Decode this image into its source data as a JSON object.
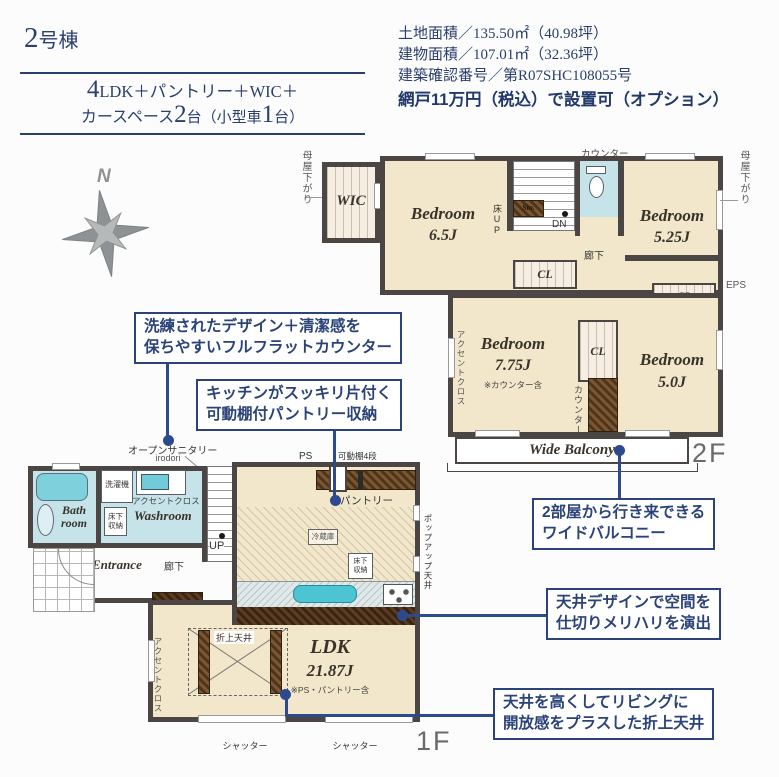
{
  "header": {
    "building_number": "2",
    "building_suffix": "号棟",
    "spec": {
      "n1": "4",
      "t1": "LDK＋パントリー＋WIC＋",
      "t2": "カースペース",
      "n2": "2",
      "t3": "台（小型車",
      "n3": "1",
      "t4": "台）"
    },
    "info": {
      "land": "土地面積／135.50㎡（40.98坪）",
      "building": "建物面積／107.01㎡（32.36坪）",
      "permit": "建築確認番号／第R07SHC108055号",
      "screen_option": "網戸11万円（税込）で設置可（オプション）"
    }
  },
  "compass": {
    "north": "N"
  },
  "floor2": {
    "floor_label": "2F",
    "moya_sagari_left": "母屋下がり",
    "moya_sagari_right": "母屋下がり",
    "wic": "WIC",
    "bedroom_65": {
      "name": "Bedroom",
      "size": "6.5J"
    },
    "yuka_up": "床UP",
    "sto": "Sto.",
    "dn": "DN",
    "counter_top": "カウンター",
    "bedroom_525": {
      "name": "Bedroom",
      "size": "5.25J"
    },
    "hallway": "廊下",
    "cl": "CL",
    "eps": "EPS",
    "accent_cloth": "アクセントクロス",
    "bedroom_775": {
      "name": "Bedroom",
      "size": "7.75J",
      "note": "※カウンター含"
    },
    "bedroom_50": {
      "name": "Bedroom",
      "size": "5.0J"
    },
    "counter_side": "カウンター",
    "balcony": "Wide Balcony"
  },
  "floor1": {
    "floor_label": "1F",
    "open_sanitary": "オープンサニタリー",
    "open_sanitary_sub": "irodori",
    "bath_a": "Bath",
    "bath_b": "room",
    "washer": "洗濯機",
    "accent_cloth_top": "アクセントクロス",
    "underfloor_a": "床下",
    "underfloor_b": "収納",
    "washroom": "Washroom",
    "sto": "Sto.",
    "entrance": "Entrance",
    "hallway": "廊下",
    "up": "UP",
    "ps": "PS",
    "movable_shelf": "可動棚4段",
    "pantry": "パントリー",
    "fridge": "冷蔵庫",
    "popup_ceiling": "ポップアップ天井",
    "coffered_ceiling": "折上天井",
    "ldk": {
      "name": "LDK",
      "size": "21.87J",
      "note": "※PS・パントリー含"
    },
    "accent_cloth_left": "アクセントクロス",
    "shutter": "シャッター"
  },
  "callouts": {
    "flat_counter": {
      "line1": "洗練されたデザイン＋清潔感を",
      "line2": "保ちやすいフルフラットカウンター"
    },
    "pantry_storage": {
      "line1": "キッチンがスッキリ片付く",
      "line2": "可動棚付パントリー収納"
    },
    "wide_balcony": {
      "line1": "2部屋から行き来できる",
      "line2": "ワイドバルコニー"
    },
    "ceiling_design": {
      "line1": "天井デザインで空間を",
      "line2": "仕切りメリハリを演出"
    },
    "coffered": {
      "line1": "天井を高くしてリビングに",
      "line2": "開放感をプラスした折上天井"
    }
  },
  "colors": {
    "navy": "#2a3f6e",
    "callout_navy": "#2b4379",
    "connector_blue": "#2d4a8f",
    "wall": "#4b4643",
    "floor_cream": "#f2e7cb",
    "water_blue": "#c6e3e9",
    "sink_teal": "#4cc4d4",
    "wood_brown": "#5e4026",
    "floor_label_gray": "#6a6a6a"
  }
}
